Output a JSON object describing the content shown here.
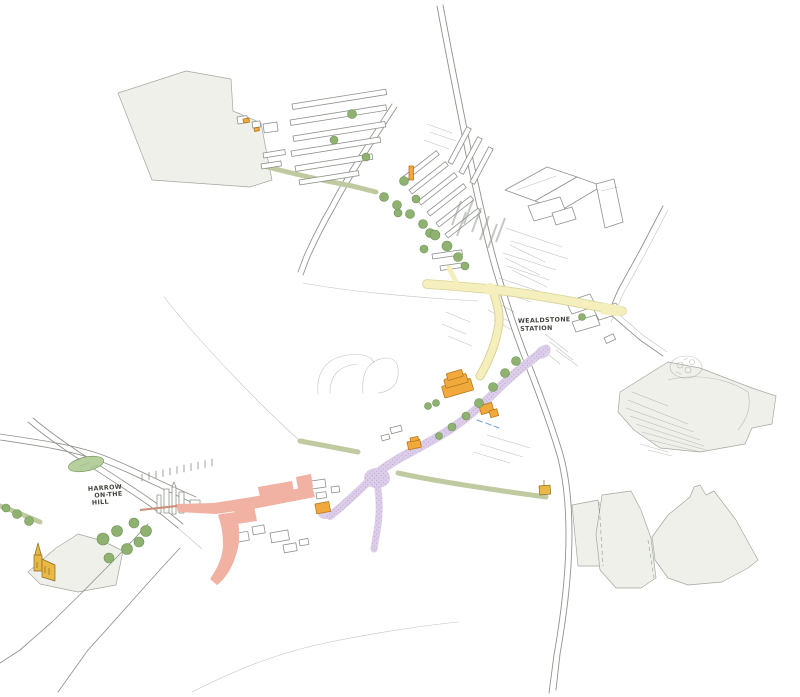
{
  "map": {
    "labels": {
      "station": {
        "line1": "WEALDSTONE",
        "line2": "STATION"
      },
      "harrow_hill": {
        "line1": "HARROW",
        "line2": "ON-THE",
        "line3": "HILL"
      }
    },
    "palette": {
      "paper": "#ffffff",
      "ink": "#8e938c",
      "ink_dark": "#45453f",
      "field_fill": "#eef0e9",
      "field_stroke": "#a2a89f",
      "route_yellow": "#f4efbc",
      "route_yellow_edge": "#d9d294",
      "route_purple": "#dccde9",
      "route_purple_dot": "#b29cd1",
      "route_pink": "#f1b1a3",
      "path_tan": "#c98f73",
      "landmark_orange": "#f2a93b",
      "landmark_orange_edge": "#b5791f",
      "church_gold": "#e9b845",
      "church_gold_edge": "#8a6a1e",
      "tree_green": "#8fb271",
      "tree_green_edge": "#6d9154",
      "hedge_olive": "#bcc79c",
      "station_lawn": "#b5cf9d",
      "water_blue": "#7ea7d8"
    }
  }
}
